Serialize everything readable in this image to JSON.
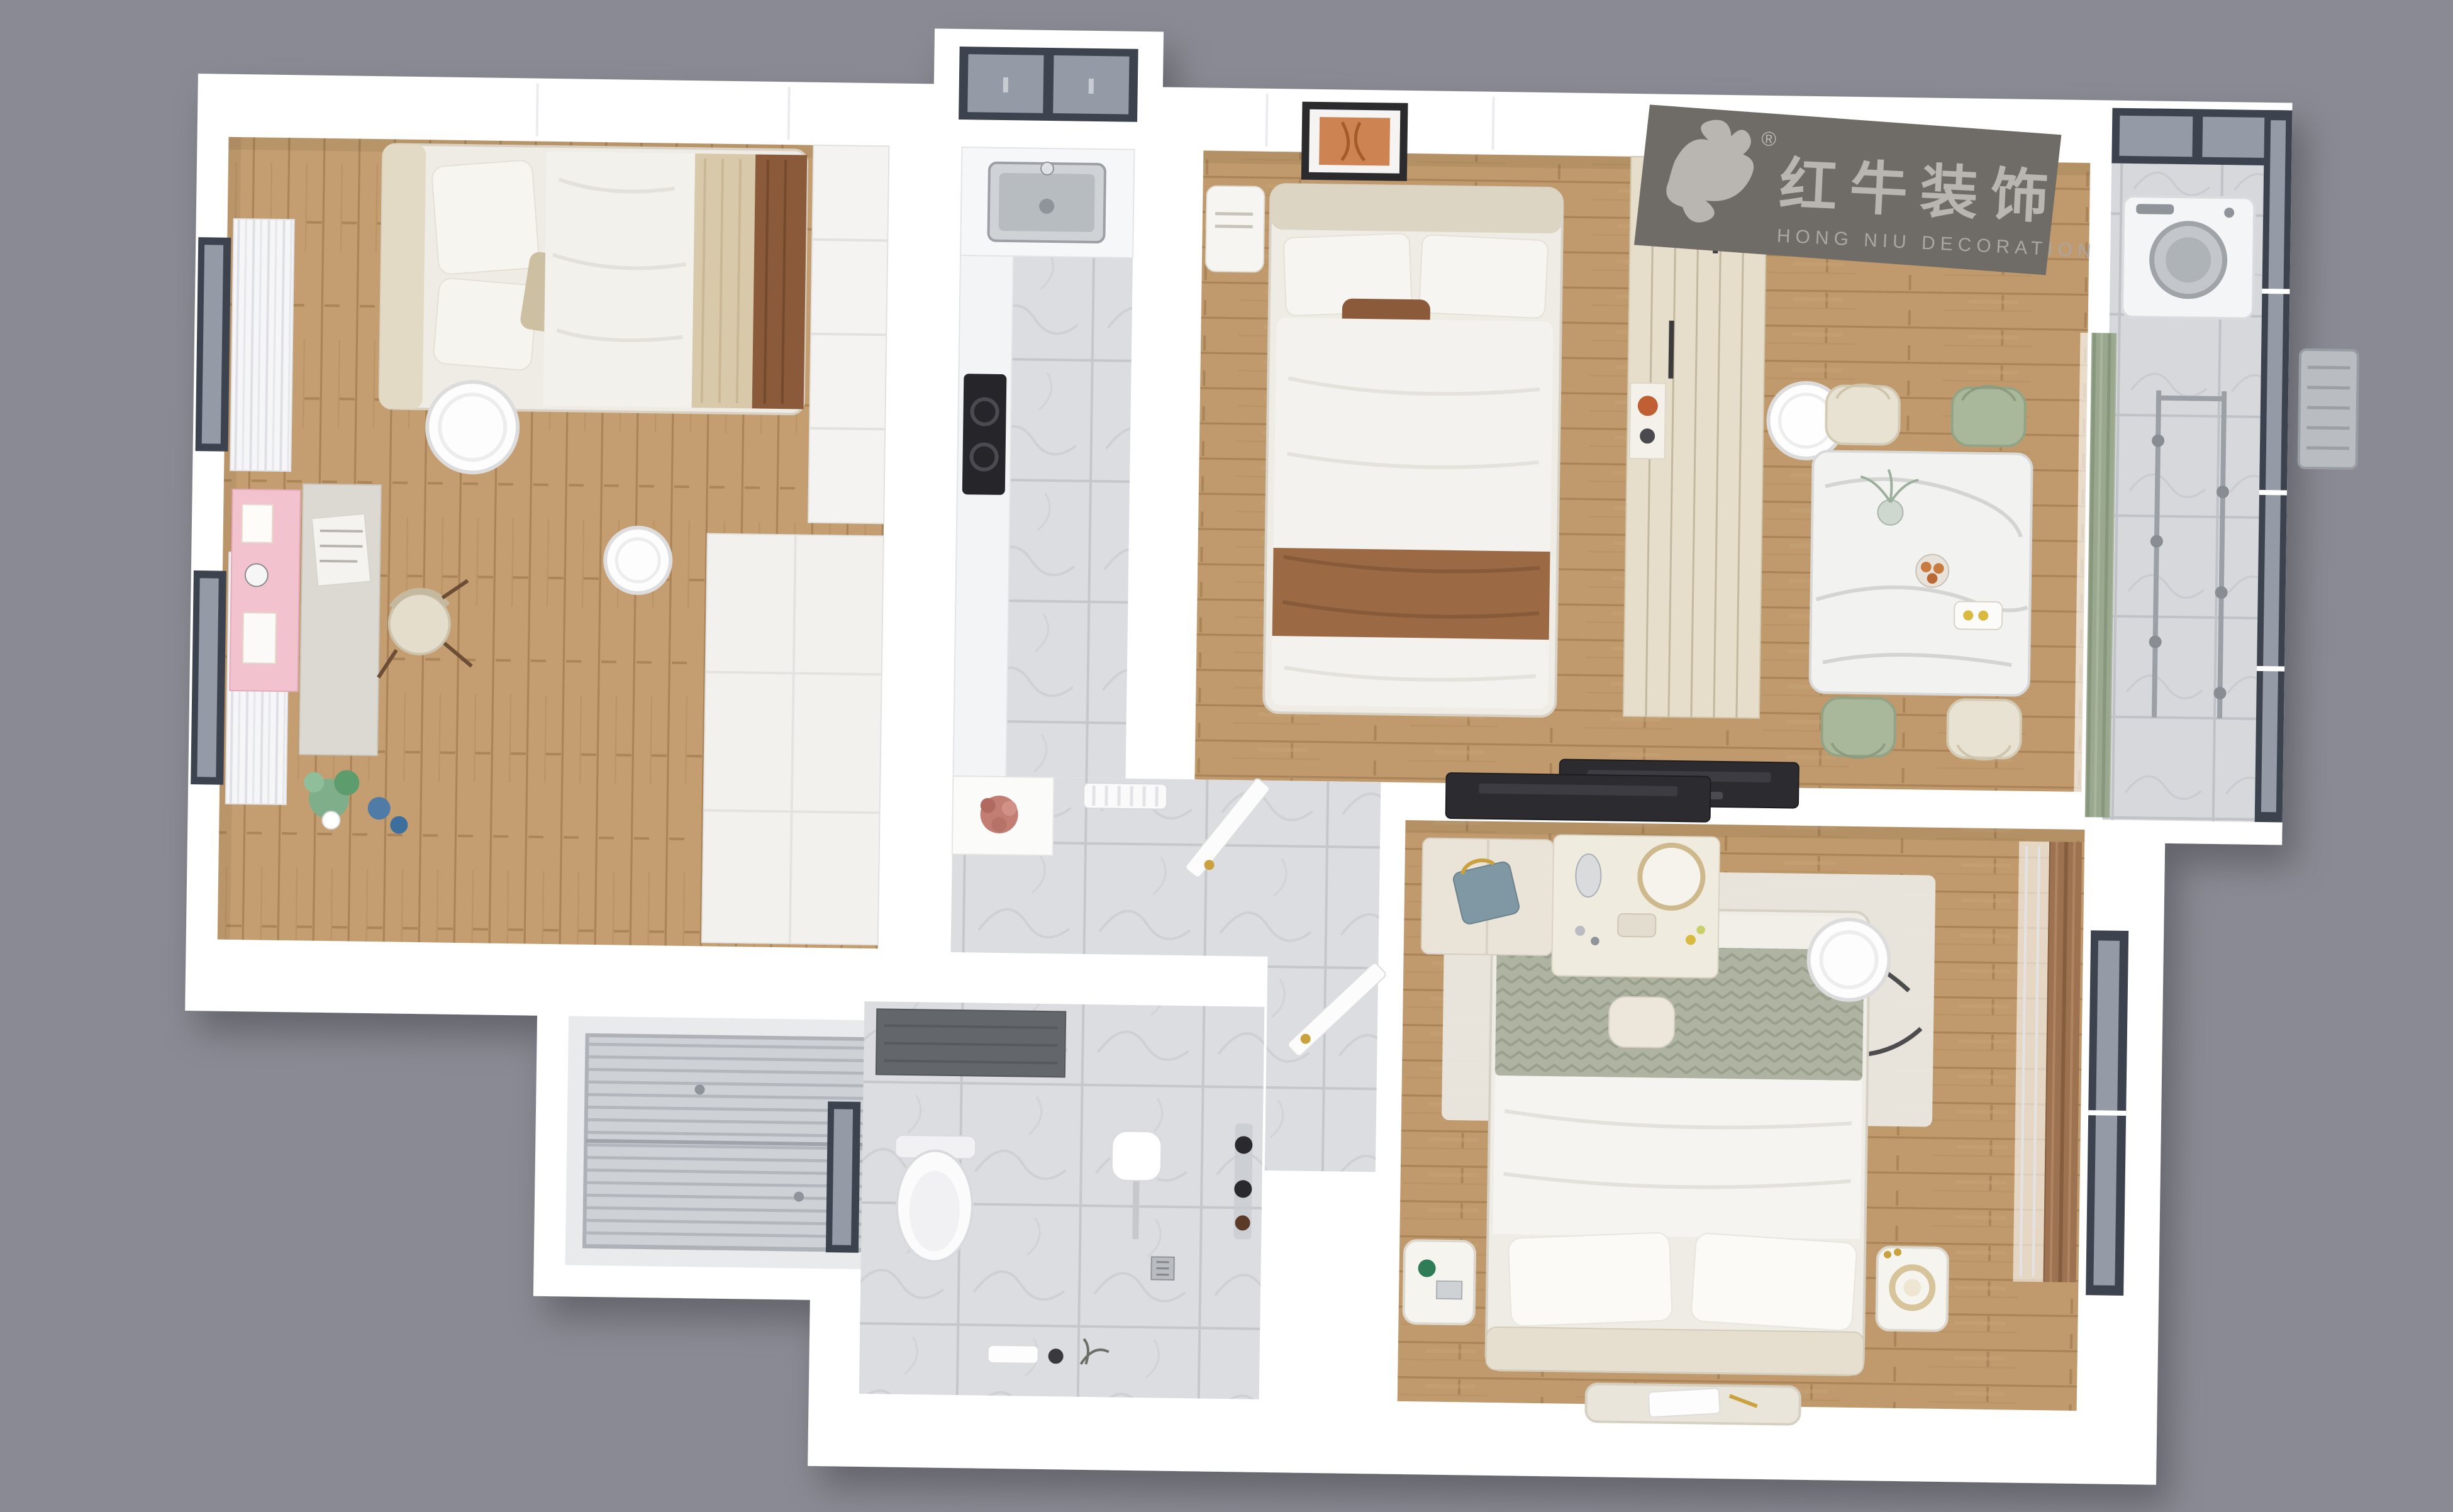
{
  "scene": {
    "description": "Top-down 3D dollhouse rendering of a furnished two-bedroom apartment floor plan on a gray backdrop"
  },
  "logo": {
    "cn": "红牛装饰",
    "en": "HONG NIU DECORATION",
    "registered": "®"
  },
  "palette": {
    "background": "#8a8a94",
    "wall": "#ffffff",
    "wallSeam": "#ececf0",
    "windowFrame": "#3d434e",
    "glass": "#959ba6",
    "woodFloor": "#c09a6c",
    "marbleTile": "#dcdde0",
    "coolTile": "#d6d8db",
    "logoPanel": "#6f6b66",
    "logoText": "#b9b6b2",
    "cream": "#efece6",
    "creamDark": "#ddd5c4",
    "wardrobeCream": "#e6decb",
    "accentGreen": "#a9b79b",
    "sageCurtain": "#9aa88f",
    "knitSage": "#aeb3a2",
    "accentBrown": "#9b6a44",
    "blanketBrown": "#8a5a3b",
    "curtainBrown": "#9c7250",
    "accentPink": "#f2c3ce",
    "artOrange": "#cd8352",
    "darkTv": "#2c2c30",
    "steel": "#c3c7cb",
    "gold": "#c9a23f"
  }
}
